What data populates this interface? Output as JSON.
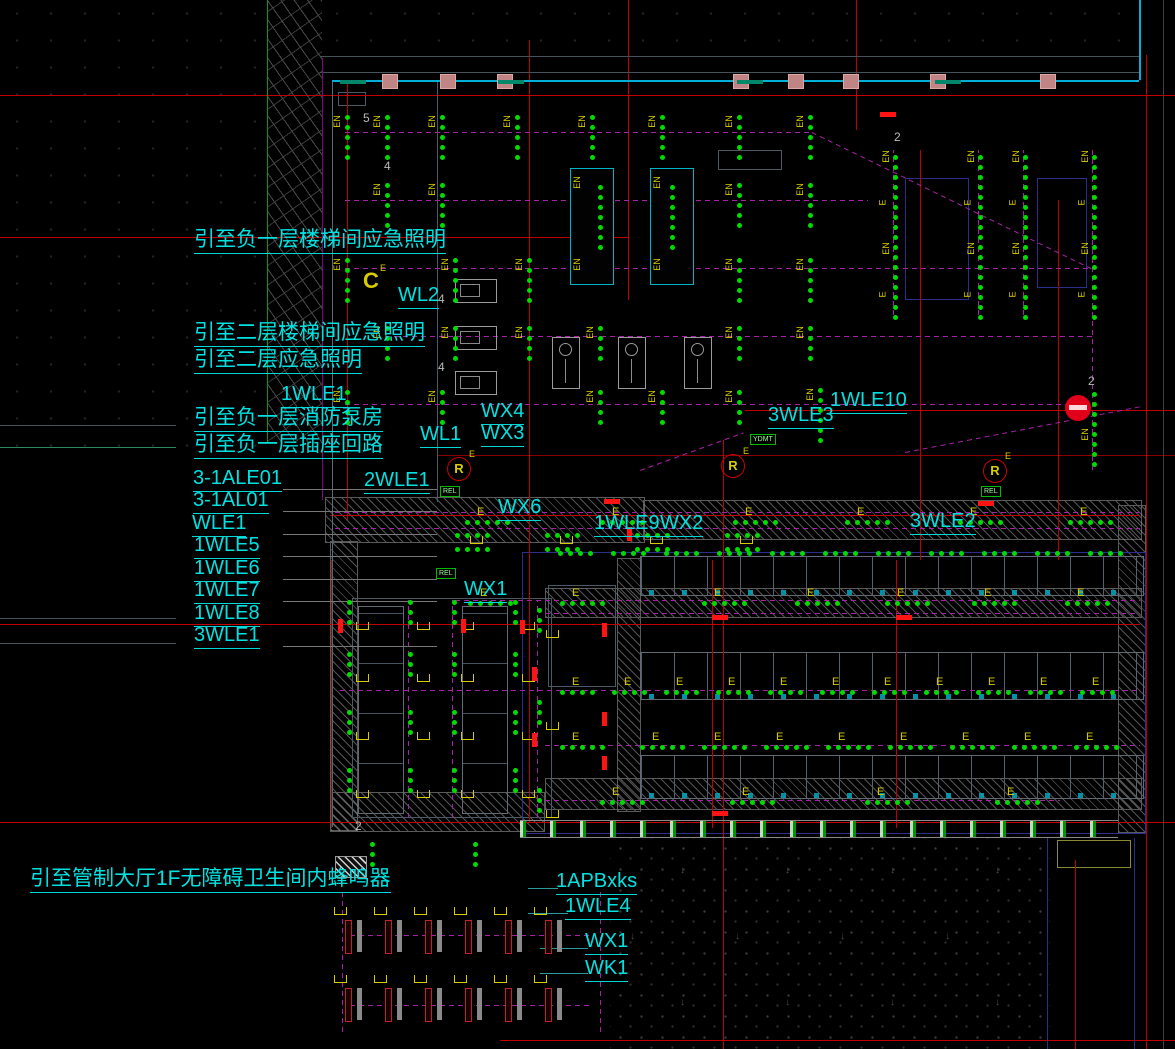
{
  "drawing_title": "emergency-lighting-floor-plan",
  "colors": {
    "background": "#000000",
    "label_cyan": "#00e2e2",
    "wall_cyan": "#00b0d8",
    "grid_red": "#c00000",
    "fire_red": "#ff1414",
    "light_green": "#00dc00",
    "tag_yellow": "#d8cc00",
    "wire_magenta": "#a820a8",
    "hatch_gray": "#a5a5a5",
    "structure_blue": "#2a2f8e",
    "device_green": "#00bb00"
  },
  "labels": [
    {
      "id": "callout-b1-stair-emergency",
      "t": "引至负一层楼梯间应急照明",
      "x": 194,
      "y": 229,
      "fs": 21,
      "ul": 1
    },
    {
      "id": "circuit-wl2",
      "t": "WL2",
      "x": 398,
      "y": 285,
      "fs": 20,
      "ul": 1
    },
    {
      "id": "callout-f2-stair-emergency",
      "t": "引至二层楼梯间应急照明",
      "x": 194,
      "y": 322,
      "fs": 21,
      "ul": 1
    },
    {
      "id": "callout-f2-emergency",
      "t": "引至二层应急照明",
      "x": 194,
      "y": 349,
      "fs": 21,
      "ul": 1
    },
    {
      "id": "circuit-1wle1",
      "t": "1WLE1",
      "x": 281,
      "y": 384,
      "fs": 20,
      "ul": 1
    },
    {
      "id": "callout-b1-fire-pump-room",
      "t": "引至负一层消防泵房",
      "x": 194,
      "y": 407,
      "fs": 21,
      "ul": 1
    },
    {
      "id": "callout-b1-socket-circuit",
      "t": "引至负一层插座回路",
      "x": 194,
      "y": 434,
      "fs": 21,
      "ul": 1
    },
    {
      "id": "circuit-wl1",
      "t": "WL1",
      "x": 420,
      "y": 424,
      "fs": 20,
      "ul": 1
    },
    {
      "id": "circuit-wx4",
      "t": "WX4",
      "x": 481,
      "y": 401,
      "fs": 20,
      "ul": 1
    },
    {
      "id": "circuit-wx3",
      "t": "WX3",
      "x": 481,
      "y": 423,
      "fs": 20,
      "ul": 1
    },
    {
      "id": "circuit-3-1ale01",
      "t": "3-1ALE01",
      "x": 193,
      "y": 468,
      "fs": 20,
      "ul": 1
    },
    {
      "id": "circuit-3-1al01",
      "t": "3-1AL01",
      "x": 193,
      "y": 490,
      "fs": 20,
      "ul": 1
    },
    {
      "id": "circuit-wle1",
      "t": "WLE1",
      "x": 192,
      "y": 513,
      "fs": 20,
      "ul": 1
    },
    {
      "id": "circuit-1wle5",
      "t": "1WLE5",
      "x": 194,
      "y": 535,
      "fs": 20,
      "ul": 1
    },
    {
      "id": "circuit-1wle6",
      "t": "1WLE6",
      "x": 194,
      "y": 558,
      "fs": 20,
      "ul": 1
    },
    {
      "id": "circuit-1wle7",
      "t": "1WLE7",
      "x": 194,
      "y": 580,
      "fs": 20,
      "ul": 1
    },
    {
      "id": "circuit-1wle8",
      "t": "1WLE8",
      "x": 194,
      "y": 603,
      "fs": 20,
      "ul": 1
    },
    {
      "id": "circuit-3wle1",
      "t": "3WLE1",
      "x": 194,
      "y": 625,
      "fs": 20,
      "ul": 1
    },
    {
      "id": "circuit-2wle1",
      "t": "2WLE1",
      "x": 364,
      "y": 470,
      "fs": 20,
      "ul": 1
    },
    {
      "id": "circuit-wx6",
      "t": "WX6",
      "x": 498,
      "y": 497,
      "fs": 20,
      "ul": 1
    },
    {
      "id": "circuit-1wle9",
      "t": "1WLE9",
      "x": 594,
      "y": 513,
      "fs": 20,
      "ul": 1
    },
    {
      "id": "circuit-wx2",
      "t": "WX2",
      "x": 660,
      "y": 513,
      "fs": 20,
      "ul": 1
    },
    {
      "id": "circuit-3wle3",
      "t": "3WLE3",
      "x": 768,
      "y": 405,
      "fs": 20,
      "ul": 1
    },
    {
      "id": "circuit-1wle10",
      "t": "1WLE10",
      "x": 830,
      "y": 390,
      "fs": 20,
      "ul": 1
    },
    {
      "id": "circuit-3wle2",
      "t": "3WLE2",
      "x": 910,
      "y": 511,
      "fs": 20,
      "ul": 1
    },
    {
      "id": "circuit-wx1-mid",
      "t": "WX1",
      "x": 464,
      "y": 579,
      "fs": 20,
      "ul": 1
    },
    {
      "id": "callout-control-hall-buzzer",
      "t": "引至管制大厅1F无障碍卫生间内蜂鸣器",
      "x": 30,
      "y": 868,
      "fs": 21,
      "ul": 1
    },
    {
      "id": "panel-1apbxks",
      "t": "1APBxks",
      "x": 556,
      "y": 871,
      "fs": 20,
      "ul": 1
    },
    {
      "id": "circuit-1wle4",
      "t": "1WLE4",
      "x": 565,
      "y": 896,
      "fs": 20,
      "ul": 1
    },
    {
      "id": "circuit-wx1-bottom",
      "t": "WX1",
      "x": 585,
      "y": 931,
      "fs": 20,
      "ul": 1
    },
    {
      "id": "circuit-wk1",
      "t": "WK1",
      "x": 585,
      "y": 958,
      "fs": 20,
      "ul": 1
    }
  ],
  "numbers": [
    {
      "t": "5",
      "x": 363,
      "y": 112
    },
    {
      "t": "4",
      "x": 384,
      "y": 160
    },
    {
      "t": "4",
      "x": 438,
      "y": 293
    },
    {
      "t": "4",
      "x": 438,
      "y": 361
    },
    {
      "t": "2",
      "x": 894,
      "y": 131
    },
    {
      "t": "2",
      "x": 1088,
      "y": 375
    },
    {
      "t": "2",
      "x": 355,
      "y": 820
    }
  ],
  "lines": [
    [
      0,
      95,
      1175,
      1,
      "#c00000",
      0
    ],
    [
      0,
      237,
      629,
      1,
      "#c00000",
      0
    ],
    [
      745,
      410,
      430,
      1,
      "#c00000",
      0
    ],
    [
      437,
      455,
      738,
      1,
      "#8a0000",
      0
    ],
    [
      330,
      515,
      810,
      1,
      "#c00000",
      0
    ],
    [
      0,
      624,
      1140,
      1,
      "#c00000",
      0
    ],
    [
      0,
      822,
      1175,
      1,
      "#c00000",
      0
    ],
    [
      500,
      1040,
      675,
      1,
      "#c00000",
      0
    ],
    [
      347,
      82,
      1,
      438,
      "#c00000",
      0
    ],
    [
      529,
      40,
      1,
      782,
      "#c00000",
      0
    ],
    [
      628,
      0,
      1,
      300,
      "#c00000",
      0
    ],
    [
      856,
      0,
      1,
      130,
      "#c00000",
      0
    ],
    [
      920,
      150,
      1,
      410,
      "#c00000",
      0
    ],
    [
      1058,
      200,
      1,
      360,
      "#c00000",
      0
    ],
    [
      712,
      560,
      1,
      268,
      "#c00000",
      0
    ],
    [
      896,
      560,
      1,
      268,
      "#c00000",
      0
    ],
    [
      1146,
      55,
      1,
      994,
      "#c00000",
      0
    ],
    [
      723,
      440,
      1,
      609,
      "#c00000",
      0
    ],
    [
      1075,
      860,
      1,
      189,
      "#c00000",
      0
    ],
    [
      331,
      560,
      1,
      268,
      "#7a1212",
      0
    ],
    [
      320,
      56,
      820,
      1,
      "#46525a",
      0
    ],
    [
      320,
      72,
      820,
      1,
      "#46525a",
      0
    ],
    [
      0,
      425,
      176,
      1,
      "#46525a",
      0
    ],
    [
      0,
      447,
      176,
      1,
      "#2a8a5a",
      0
    ],
    [
      0,
      618,
      176,
      1,
      "#46525a",
      0
    ],
    [
      0,
      643,
      176,
      1,
      "#46525a",
      0
    ],
    [
      1163,
      0,
      1,
      1049,
      "#3a4248",
      0
    ],
    [
      332,
      80,
      1,
      747,
      "#5a6a74",
      0
    ],
    [
      437,
      82,
      1,
      420,
      "#4a5a64",
      0
    ],
    [
      267,
      0,
      1,
      443,
      "#00a000",
      0
    ],
    [
      322,
      58,
      1,
      442,
      "#7a0a7a",
      0
    ],
    [
      332,
      80,
      807,
      2,
      "#00b0d8",
      0
    ],
    [
      1139,
      0,
      2,
      80,
      "#00b0d8",
      0
    ],
    [
      345,
      132,
      467,
      1,
      "#a820a8",
      1
    ],
    [
      345,
      200,
      523,
      1,
      "#a820a8",
      1
    ],
    [
      345,
      268,
      750,
      1,
      "#a820a8",
      1
    ],
    [
      385,
      336,
      710,
      1,
      "#a820a8",
      1
    ],
    [
      345,
      404,
      750,
      1,
      "#a820a8",
      1
    ],
    [
      335,
      512,
      805,
      1,
      "#a820a8",
      1
    ],
    [
      335,
      528,
      805,
      1,
      "#a820a8",
      1
    ],
    [
      455,
      600,
      685,
      1,
      "#a820a8",
      1
    ],
    [
      545,
      613,
      595,
      1,
      "#a820a8",
      1
    ],
    [
      340,
      690,
      800,
      1,
      "#a820a8",
      1
    ],
    [
      545,
      745,
      595,
      1,
      "#a820a8",
      1
    ],
    [
      545,
      800,
      515,
      1,
      "#a820a8",
      1
    ],
    [
      408,
      600,
      1,
      218,
      "#a820a8",
      1
    ],
    [
      452,
      600,
      1,
      218,
      "#a820a8",
      1
    ],
    [
      537,
      600,
      1,
      218,
      "#a820a8",
      1
    ],
    [
      893,
      150,
      1,
      165,
      "#a820a8",
      1
    ],
    [
      978,
      150,
      1,
      165,
      "#a820a8",
      1
    ],
    [
      1023,
      150,
      1,
      165,
      "#a820a8",
      1
    ],
    [
      1092,
      150,
      1,
      320,
      "#a820a8",
      1
    ],
    [
      350,
      935,
      242,
      1,
      "#a820a8",
      1
    ],
    [
      350,
      1005,
      242,
      1,
      "#a820a8",
      1
    ],
    [
      342,
      892,
      1,
      140,
      "#a820a8",
      1
    ],
    [
      600,
      892,
      1,
      140,
      "#a820a8",
      1
    ],
    [
      812,
      132,
      312,
      1,
      "#a820a8",
      1,
      26
    ],
    [
      905,
      452,
      240,
      1,
      "#a820a8",
      1,
      -11
    ],
    [
      640,
      470,
      110,
      1,
      "#a820a8",
      1,
      -20
    ],
    [
      1047,
      838,
      1,
      211,
      "#2a2f8e",
      0
    ],
    [
      1134,
      838,
      1,
      211,
      "#2a2f8e",
      0
    ],
    [
      283,
      489,
      154,
      1,
      "#777777",
      0
    ],
    [
      283,
      511,
      154,
      1,
      "#777777",
      0
    ],
    [
      283,
      534,
      154,
      1,
      "#777777",
      0
    ],
    [
      283,
      556,
      154,
      1,
      "#777777",
      0
    ],
    [
      283,
      579,
      154,
      1,
      "#777777",
      0
    ],
    [
      283,
      601,
      154,
      1,
      "#777777",
      0
    ],
    [
      283,
      646,
      154,
      1,
      "#777777",
      0
    ],
    [
      528,
      888,
      30,
      1,
      "#2a9a9a",
      0
    ],
    [
      528,
      913,
      40,
      1,
      "#2a9a9a",
      0
    ],
    [
      540,
      948,
      48,
      1,
      "#2a9a9a",
      0
    ],
    [
      540,
      973,
      48,
      1,
      "#2a9a9a",
      0
    ]
  ],
  "hatch_rects": [
    [
      325,
      497,
      318,
      44
    ],
    [
      643,
      500,
      497,
      38
    ],
    [
      330,
      541,
      26,
      288
    ],
    [
      617,
      558,
      22,
      252
    ],
    [
      1118,
      505,
      26,
      326
    ],
    [
      545,
      588,
      595,
      28
    ],
    [
      545,
      778,
      595,
      30
    ],
    [
      330,
      792,
      213,
      38
    ]
  ],
  "hatch_dense": [
    [
      335,
      856,
      30,
      20
    ]
  ],
  "locker_rects": [
    [
      640,
      556,
      502,
      38
    ],
    [
      640,
      652,
      502,
      46
    ],
    [
      640,
      755,
      502,
      42
    ]
  ],
  "bay_rects": [
    [
      358,
      606,
      44,
      206
    ],
    [
      462,
      606,
      44,
      206
    ]
  ],
  "room_rects": [
    [
      352,
      598,
      198,
      218
    ],
    [
      548,
      585,
      66,
      100
    ],
    [
      338,
      92,
      26,
      12
    ],
    [
      718,
      150,
      62,
      18
    ]
  ],
  "blue_rects": [
    [
      905,
      178,
      62,
      120
    ],
    [
      1037,
      178,
      48,
      108
    ],
    [
      522,
      552,
      622,
      280
    ]
  ],
  "olive_rects": [
    [
      1057,
      840,
      72,
      26
    ]
  ],
  "texture_rects": [
    [
      0,
      0,
      266,
      455
    ],
    [
      320,
      0,
      820,
      56
    ]
  ],
  "brick_rects": [
    [
      268,
      0,
      54,
      443
    ]
  ],
  "paving_rects": [
    [
      610,
      838,
      440,
      211
    ]
  ],
  "doorstrip": [
    520,
    820,
    598,
    16
  ],
  "doors_pink": [
    382,
    440,
    497,
    733,
    788,
    843,
    930,
    1040
  ],
  "sills": [
    340,
    498,
    737,
    935
  ],
  "escalators": [
    [
      570,
      168
    ],
    [
      650,
      168
    ]
  ],
  "esc_size": [
    42,
    115
  ],
  "fcus": [
    [
      455,
      279
    ],
    [
      455,
      326
    ],
    [
      455,
      371
    ]
  ],
  "bottles": [
    [
      552,
      337
    ],
    [
      618,
      337
    ],
    [
      684,
      337
    ]
  ],
  "vcols": [
    {
      "y": 115,
      "n": 5,
      "lab": "EN",
      "xs": [
        345,
        385,
        440,
        515,
        590,
        660,
        737,
        808
      ]
    },
    {
      "y": 183,
      "n": 5,
      "lab": "EN",
      "xs": [
        385,
        440,
        737,
        808
      ]
    },
    {
      "y": 258,
      "n": 5,
      "lab": "EN",
      "xs": [
        345,
        453,
        527,
        737,
        808
      ]
    },
    {
      "y": 326,
      "n": 4,
      "lab": "EN",
      "xs": [
        385,
        453,
        527,
        598,
        737,
        808
      ]
    },
    {
      "y": 390,
      "n": 4,
      "lab": "EN",
      "xs": [
        345,
        440,
        598,
        660,
        737
      ]
    },
    {
      "y": 388,
      "n": 6,
      "lab": "EN",
      "xs": [
        818
      ]
    },
    {
      "y": 185,
      "n": 7,
      "lab": "",
      "xs": [
        598,
        670
      ]
    },
    {
      "y": 155,
      "n": 17,
      "lab": "",
      "xs": [
        893,
        978,
        1023,
        1092
      ]
    },
    {
      "y": 392,
      "n": 8,
      "lab": "E",
      "xs": [
        1092
      ]
    },
    {
      "y": 600,
      "n": 3,
      "lab": "",
      "xs": [
        347,
        408,
        452,
        513
      ]
    },
    {
      "y": 652,
      "n": 3,
      "lab": "",
      "xs": [
        347,
        408,
        452,
        513
      ]
    },
    {
      "y": 710,
      "n": 3,
      "lab": "",
      "xs": [
        347,
        408,
        452,
        513
      ]
    },
    {
      "y": 768,
      "n": 3,
      "lab": "",
      "xs": [
        347,
        408,
        452,
        513
      ]
    },
    {
      "y": 608,
      "n": 3,
      "lab": "",
      "xs": [
        537
      ]
    },
    {
      "y": 700,
      "n": 3,
      "lab": "",
      "xs": [
        537
      ]
    },
    {
      "y": 788,
      "n": 3,
      "lab": "",
      "xs": [
        537
      ]
    },
    {
      "y": 842,
      "n": 3,
      "lab": "",
      "xs": [
        370,
        473
      ]
    }
  ],
  "vlabels": [
    {
      "t": "EN",
      "x": 880,
      "y": 152
    },
    {
      "t": "E",
      "x": 880,
      "y": 198
    },
    {
      "t": "EN",
      "x": 880,
      "y": 244
    },
    {
      "t": "E",
      "x": 880,
      "y": 290
    },
    {
      "t": "EN",
      "x": 965,
      "y": 152
    },
    {
      "t": "E",
      "x": 965,
      "y": 198
    },
    {
      "t": "EN",
      "x": 965,
      "y": 244
    },
    {
      "t": "E",
      "x": 965,
      "y": 290
    },
    {
      "t": "EN",
      "x": 1010,
      "y": 152
    },
    {
      "t": "E",
      "x": 1010,
      "y": 198
    },
    {
      "t": "EN",
      "x": 1010,
      "y": 244
    },
    {
      "t": "E",
      "x": 1010,
      "y": 290
    },
    {
      "t": "EN",
      "x": 1079,
      "y": 152
    },
    {
      "t": "E",
      "x": 1079,
      "y": 198
    },
    {
      "t": "EN",
      "x": 1079,
      "y": 244
    },
    {
      "t": "E",
      "x": 1079,
      "y": 290
    },
    {
      "t": "EN",
      "x": 1079,
      "y": 430
    }
  ],
  "hrows": [
    {
      "y": 520,
      "n": 5,
      "lab": "E",
      "xs": [
        465,
        600,
        733,
        845,
        958,
        1068
      ]
    },
    {
      "y": 551,
      "n": 4,
      "lab": "",
      "xs": [
        558,
        611,
        664,
        717,
        770,
        823,
        876,
        929,
        982,
        1035,
        1088
      ]
    },
    {
      "y": 601,
      "n": 5,
      "lab": "E",
      "xs": [
        468,
        560,
        702,
        795,
        885,
        972,
        1065
      ]
    },
    {
      "y": 533,
      "n": 4,
      "lab": "",
      "xs": [
        455,
        545,
        635,
        725
      ]
    },
    {
      "y": 547,
      "n": 4,
      "lab": "",
      "xs": [
        455,
        545,
        635,
        725
      ]
    },
    {
      "y": 690,
      "n": 4,
      "lab": "E",
      "xs": [
        560,
        612,
        664,
        716,
        768,
        820,
        872,
        924,
        976,
        1028,
        1080
      ]
    },
    {
      "y": 745,
      "n": 5,
      "lab": "E",
      "xs": [
        560,
        640,
        702,
        764,
        826,
        888,
        950,
        1012,
        1074
      ]
    },
    {
      "y": 800,
      "n": 5,
      "lab": "E",
      "xs": [
        600,
        730,
        865,
        995
      ]
    }
  ],
  "brackets": [
    [
      356,
      622
    ],
    [
      417,
      622
    ],
    [
      461,
      622
    ],
    [
      522,
      622
    ],
    [
      356,
      674
    ],
    [
      417,
      674
    ],
    [
      461,
      674
    ],
    [
      522,
      674
    ],
    [
      356,
      732
    ],
    [
      417,
      732
    ],
    [
      461,
      732
    ],
    [
      522,
      732
    ],
    [
      356,
      790
    ],
    [
      417,
      790
    ],
    [
      461,
      790
    ],
    [
      522,
      790
    ],
    [
      546,
      630
    ],
    [
      546,
      722
    ],
    [
      546,
      810
    ],
    [
      470,
      536
    ],
    [
      560,
      536
    ],
    [
      650,
      536
    ],
    [
      740,
      536
    ]
  ],
  "fires_h": [
    [
      604,
      499
    ],
    [
      978,
      501
    ],
    [
      712,
      615
    ],
    [
      896,
      615
    ],
    [
      712,
      811
    ],
    [
      880,
      112
    ]
  ],
  "fires_v": [
    [
      338,
      619
    ],
    [
      461,
      619
    ],
    [
      520,
      620
    ],
    [
      532,
      667
    ],
    [
      532,
      733
    ],
    [
      602,
      623
    ],
    [
      602,
      712
    ],
    [
      602,
      756
    ],
    [
      627,
      527
    ]
  ],
  "symbols": {
    "c_symbol": {
      "t": "C",
      "sup": "E",
      "x": 363,
      "y": 270
    },
    "r_symbols": [
      {
        "x": 447,
        "y": 457
      },
      {
        "x": 721,
        "y": 454
      },
      {
        "x": 983,
        "y": 459
      }
    ],
    "r_text": "R",
    "r_sup": "E",
    "rel_boxes": [
      {
        "t": "REL",
        "x": 440,
        "y": 486
      },
      {
        "t": "REL",
        "x": 436,
        "y": 568
      },
      {
        "t": "REL",
        "x": 981,
        "y": 486
      }
    ],
    "ydmt_box": {
      "t": "YDMT",
      "x": 750,
      "y": 434
    },
    "alarm": {
      "x": 1065,
      "y": 395
    }
  },
  "gates": {
    "xs": [
      345,
      385,
      425,
      465,
      505,
      545
    ],
    "rows": [
      920,
      988
    ],
    "bar_h": 32
  }
}
